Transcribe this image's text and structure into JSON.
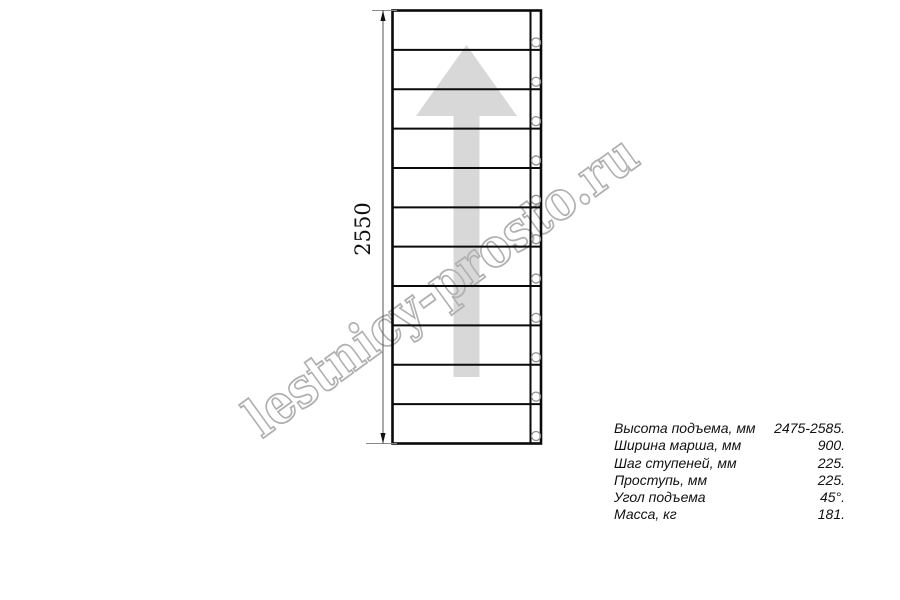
{
  "watermark": {
    "text": "lestnicy-prosto.ru",
    "outline_color": "#b0b0b0"
  },
  "drawing": {
    "dimension_label": "2550",
    "steps_visible": 11,
    "bolt_count": 11,
    "arrow_color": "#d8d8d8",
    "line_color": "#0a0a0a"
  },
  "spec_table": {
    "rows": [
      {
        "label": "Высота подъема, мм",
        "value": "2475-2585."
      },
      {
        "label": "Ширина марша, мм",
        "value": "900."
      },
      {
        "label": "Шаг ступеней, мм",
        "value": "225."
      },
      {
        "label": "Проступь, мм",
        "value": "225."
      },
      {
        "label": "Угол подъема",
        "value": "45°."
      },
      {
        "label": "Масса, кг",
        "value": "181."
      }
    ]
  }
}
